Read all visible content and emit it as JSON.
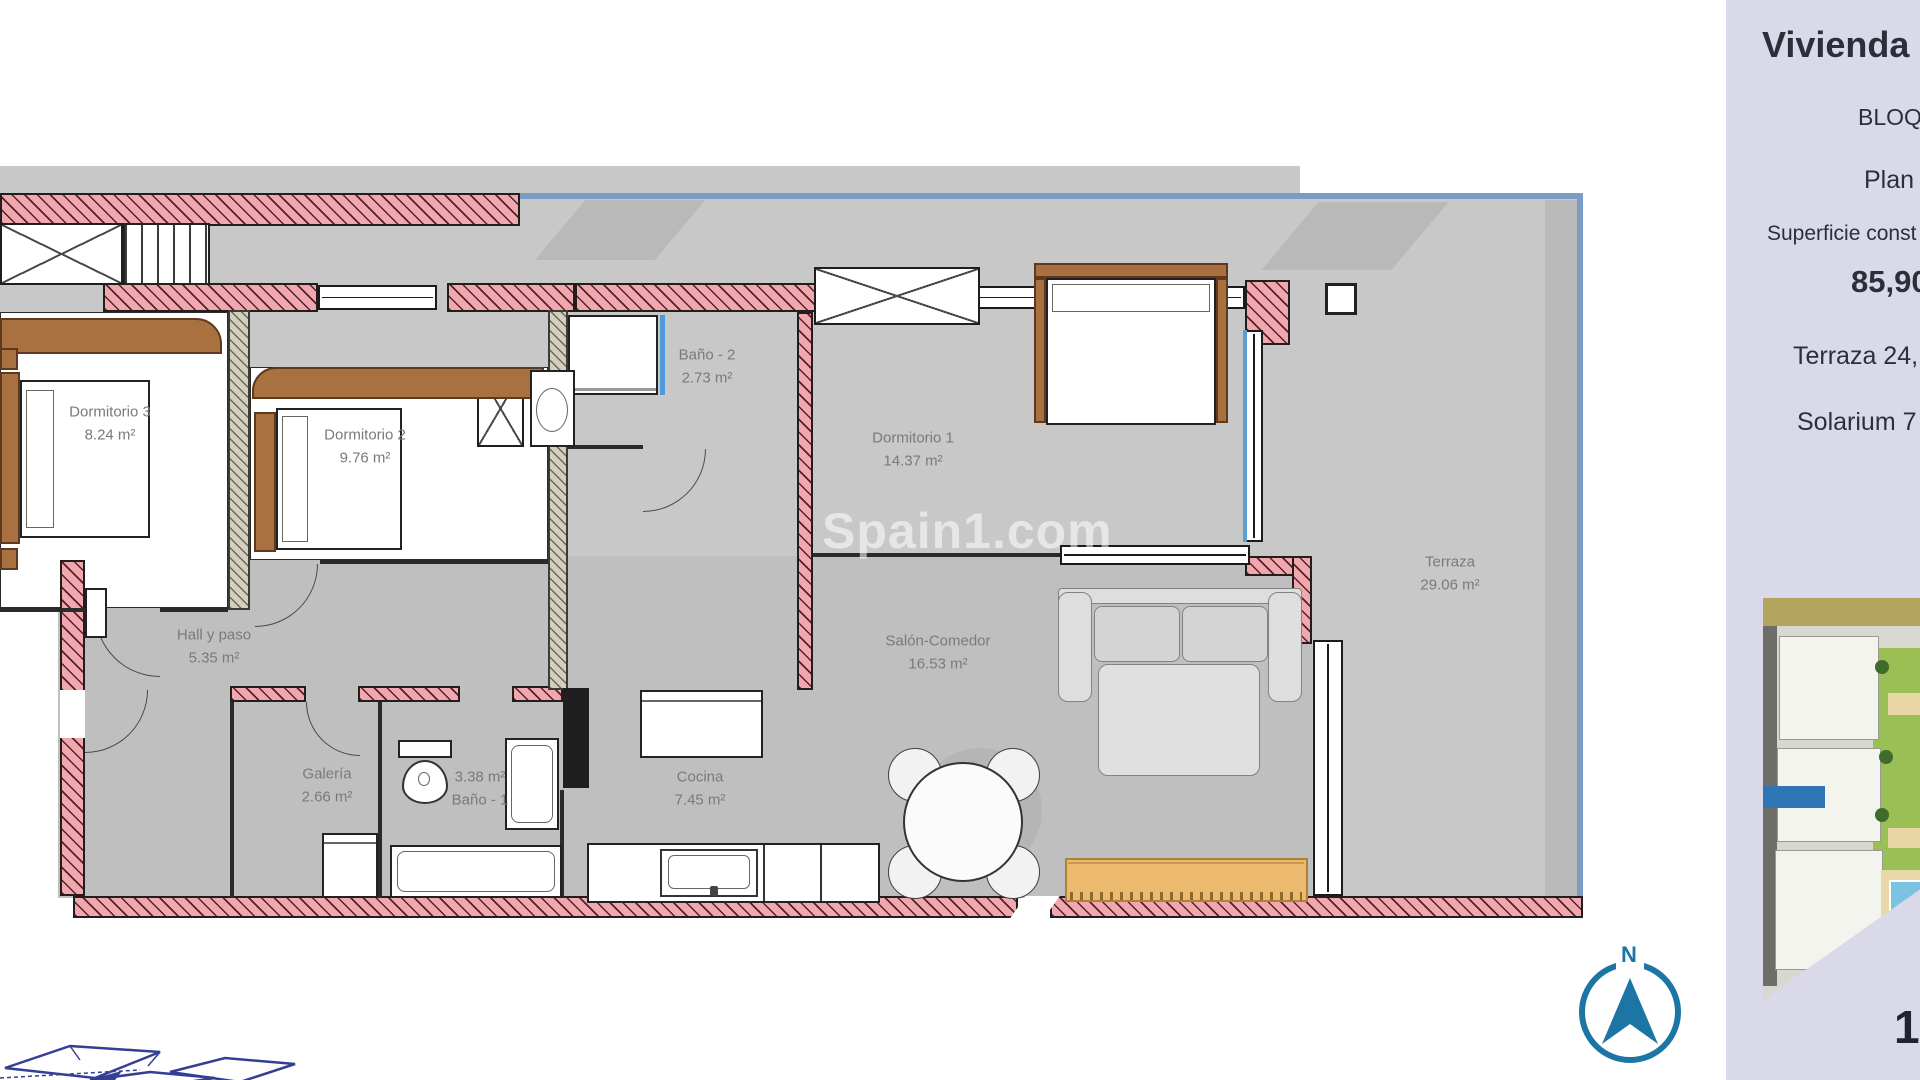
{
  "plan": {
    "watermark": "Spain1.com",
    "compass_n": "N",
    "rooms": [
      {
        "id": "dormitorio-3",
        "line1": "Dormitorio 3",
        "line2": "8.24 m²"
      },
      {
        "id": "dormitorio-2",
        "line1": "Dormitorio 2",
        "line2": "9.76 m²"
      },
      {
        "id": "bano-2",
        "line1": "Baño - 2",
        "line2": "2.73 m²"
      },
      {
        "id": "dormitorio-1",
        "line1": "Dormitorio 1",
        "line2": "14.37 m²"
      },
      {
        "id": "terraza",
        "line1": "Terraza",
        "line2": "29.06 m²"
      },
      {
        "id": "hall-y-paso",
        "line1": "Hall y paso",
        "line2": "5.35 m²"
      },
      {
        "id": "salon-comedor",
        "line1": "Salón-Comedor",
        "line2": "16.53 m²"
      },
      {
        "id": "galeria",
        "line1": "Galería",
        "line2": "2.66 m²"
      },
      {
        "id": "bano-1",
        "line1": "3.38 m²",
        "line2": "Baño - 1"
      },
      {
        "id": "cocina",
        "line1": "Cocina",
        "line2": "7.45 m²"
      }
    ]
  },
  "sidebar": {
    "title": "Vivienda",
    "block": "BLOQ",
    "floor": "Plan",
    "surface_label": "Superficie const",
    "surface_value": "85,90",
    "terrace": "Terraza 24,",
    "solarium": "Solarium 7",
    "page_number": "1"
  },
  "colors": {
    "wall_pink": "#f2a6ad",
    "boundary_blue": "#7b9dc3",
    "compass_blue": "#1c75a5",
    "unit_highlight_blue": "#2e75b6",
    "sidebar_bg": "#d9d9ea",
    "floor_gray": "#c8c8c8",
    "sketch_navy": "#333f94",
    "bench_tan": "#ecba6e"
  }
}
